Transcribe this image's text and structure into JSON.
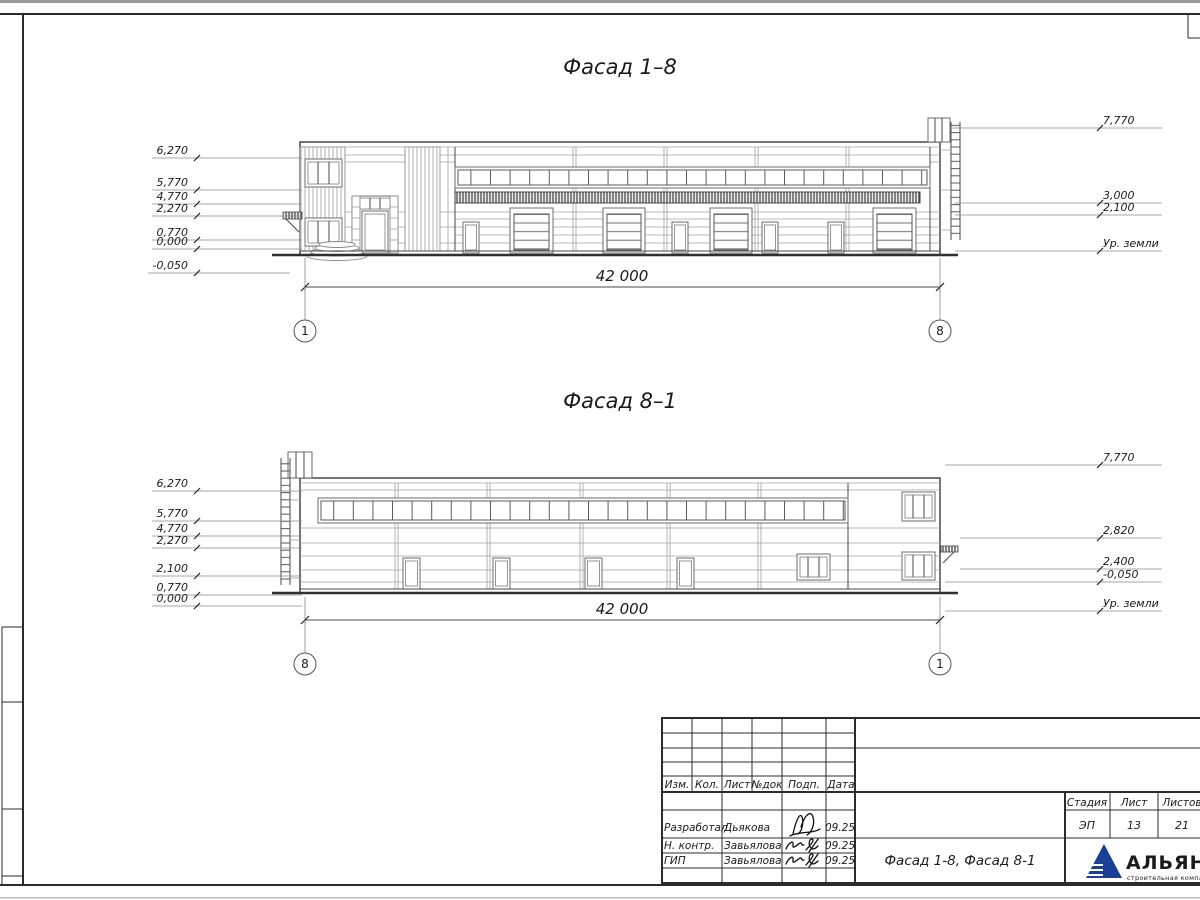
{
  "f18": {
    "title": "Фасад 1–8",
    "marks_left": [
      "6,270",
      "5,770",
      "4,770",
      "2,270",
      "0,770",
      "0,000",
      "-0,050"
    ],
    "marks_right": [
      "7,770",
      "3,000",
      "2,100"
    ],
    "ground": "Ур. земли",
    "dim": "42 000",
    "axis_left": "1",
    "axis_right": "8"
  },
  "f81": {
    "title": "Фасад 8–1",
    "marks_left": [
      "6,270",
      "5,770",
      "4,770",
      "2,270",
      "2,100",
      "0,770",
      "0,000"
    ],
    "marks_right": [
      "7,770",
      "2,820",
      "2,400",
      "-0,050"
    ],
    "ground": "Ур. земли",
    "dim": "42 000",
    "axis_left": "8",
    "axis_right": "1"
  },
  "titleblock": {
    "h_izm": "Изм.",
    "h_kol": "Кол.",
    "h_list": "Лист",
    "h_ndok": "№док",
    "h_podp": "Подп.",
    "h_data": "Дата",
    "rows": [
      {
        "role": "Разработал",
        "name": "Дьякова",
        "date": "09.25"
      },
      {
        "role": "Н. контр.",
        "name": "Завьялова",
        "date": "09.25"
      },
      {
        "role": "ГИП",
        "name": "Завьялова",
        "date": "09.25"
      }
    ],
    "doc_title": "Фасад 1-8, Фасад 8-1",
    "h_stage": "Стадия",
    "h_sheet": "Лист",
    "h_sheets": "Листов",
    "stage": "ЭП",
    "sheet": "13",
    "sheets": "21",
    "company": "АЛЬЯНС",
    "tagline": "строительная компания",
    "logo_color": "#1b3f94",
    "tagline_color": "#4a7ad0"
  }
}
